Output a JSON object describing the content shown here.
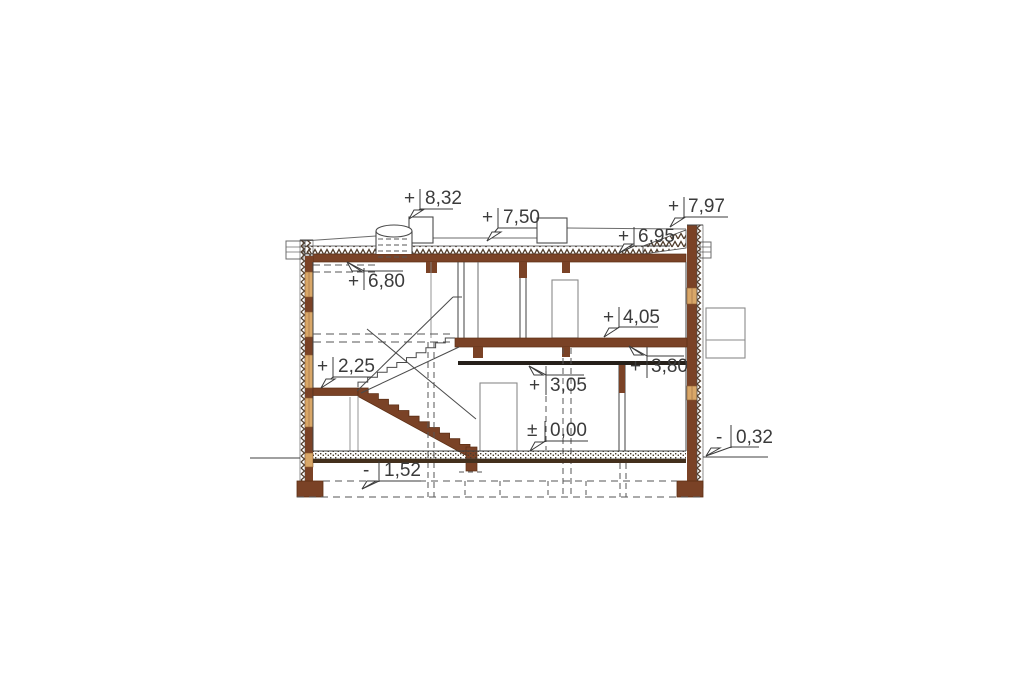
{
  "markers": [
    {
      "id": "m832",
      "sign": "+",
      "value": "8,32"
    },
    {
      "id": "m750",
      "sign": "+",
      "value": "7,50"
    },
    {
      "id": "m797",
      "sign": "+",
      "value": "7,97"
    },
    {
      "id": "m695",
      "sign": "+",
      "value": "6,95"
    },
    {
      "id": "m680",
      "sign": "+",
      "value": "6,80"
    },
    {
      "id": "m405",
      "sign": "+",
      "value": "4,05"
    },
    {
      "id": "m380",
      "sign": "+",
      "value": "3,80"
    },
    {
      "id": "m305",
      "sign": "+",
      "value": "3,05"
    },
    {
      "id": "m225",
      "sign": "+",
      "value": "2,25"
    },
    {
      "id": "m000",
      "sign": "±",
      "value": "0,00"
    },
    {
      "id": "m032",
      "sign": "-",
      "value": "0,32"
    },
    {
      "id": "m152",
      "sign": "-",
      "value": "1,52"
    }
  ],
  "colors": {
    "wood_dark": "#7a4226",
    "wood_tan": "#d9a768",
    "slab_line": "#26201a",
    "floor_base": "#44301d",
    "line": "#404040",
    "label_text": "#3b3b3b"
  }
}
